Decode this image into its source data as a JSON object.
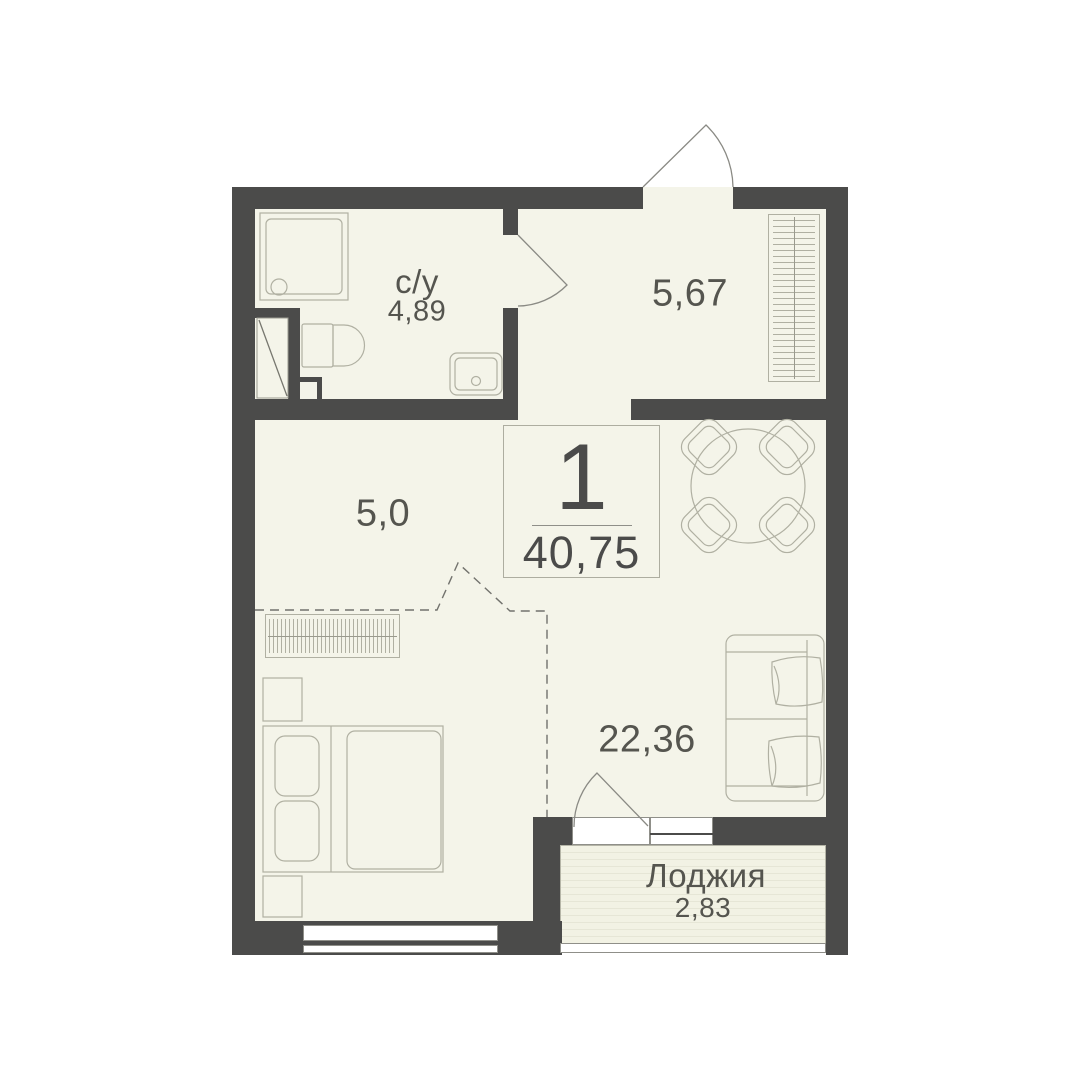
{
  "info_box": {
    "rooms_count": "1",
    "total_area": "40,75"
  },
  "rooms": {
    "bathroom": {
      "label": "с/у",
      "area": "4,89"
    },
    "hallway": {
      "area": "5,67"
    },
    "corridor": {
      "area": "5,0"
    },
    "living": {
      "area": "22,36"
    },
    "loggia": {
      "label": "Лоджия",
      "area": "2,83"
    }
  },
  "colors": {
    "wall": "#4b4b4a",
    "floor": "#f4f4e9",
    "furniture_line": "#b0b0a2",
    "door_line": "#8a8a84",
    "text": "#52524c"
  }
}
